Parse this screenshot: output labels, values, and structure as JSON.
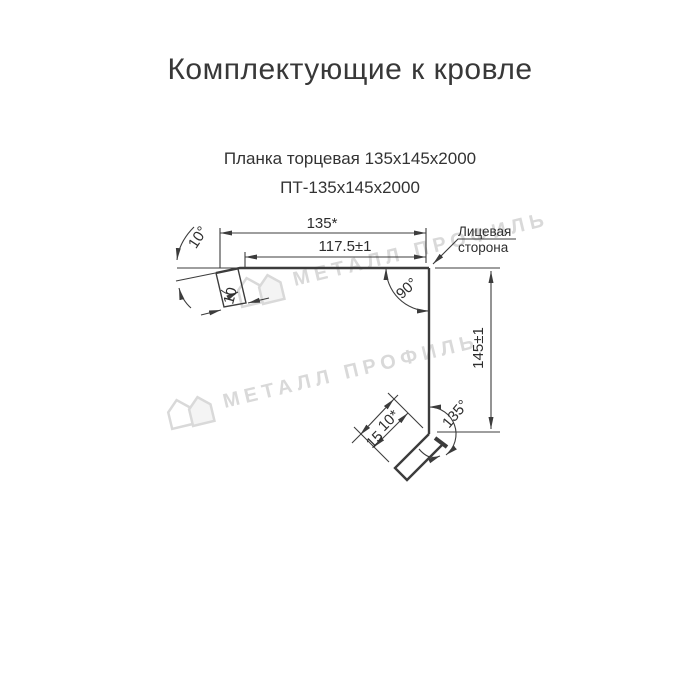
{
  "header": {
    "title": "Комплектующие к кровле",
    "product_name": "Планка торцевая 135х145х2000",
    "product_code": "ПТ-135х145х2000"
  },
  "drawing": {
    "dimensions": {
      "top_width_total": "135*",
      "top_width_inner": "117.5±1",
      "right_height": "145±1",
      "top_corner_angle": "90°",
      "bottom_corner_angle": "135°",
      "left_bend_angle": "10°",
      "top_hem_length": "10",
      "bottom_hem_length": "10*",
      "bottom_flange_length": "15"
    },
    "annotations": {
      "face_side_line1": "Лицевая",
      "face_side_line2": "сторона"
    },
    "colors": {
      "line": "#3c3c3c",
      "text": "#2d2d2d",
      "watermark": "#d9d9d9"
    }
  },
  "watermark": {
    "text": "МЕТАЛЛ ПРОФИЛЬ"
  }
}
